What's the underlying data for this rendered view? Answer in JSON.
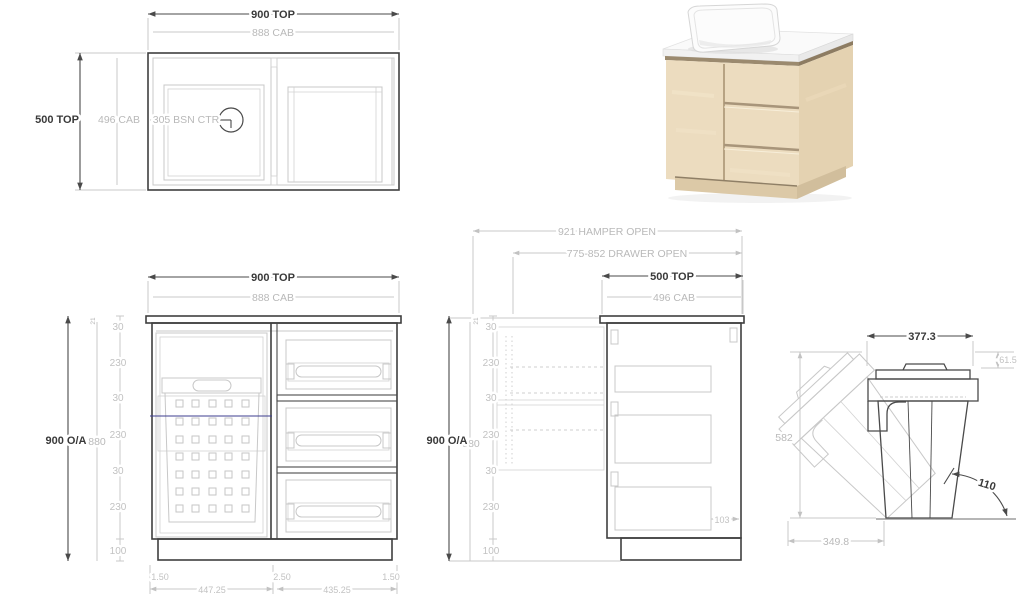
{
  "colors": {
    "background": "#ffffff",
    "line_dark": "#3f3f3f",
    "line_light": "#c8c8c8",
    "text_dark": "#3a3a3a",
    "text_light": "#b9b9b9",
    "marker_blue": "#3d3d8f",
    "wood_front": "#ecdcbf",
    "wood_side": "#e4d2b1",
    "counter_white": "#f5f5f5"
  },
  "plan_view": {
    "dim_top": "900 TOP",
    "dim_top_cab": "888 CAB",
    "dim_depth": "500 TOP",
    "dim_depth_cab": "496 CAB",
    "dim_basin_center": "305 BSN CTR"
  },
  "front_view": {
    "dim_top": "900 TOP",
    "dim_top_cab": "888 CAB",
    "dim_overall": "900 O/A",
    "dim_cab_height": "880",
    "dim_counter_thickness": "21",
    "chain": [
      "30",
      "230",
      "30",
      "230",
      "30",
      "230",
      "100"
    ],
    "bottom_edges": [
      "1.50",
      "2.50",
      "1.50"
    ],
    "dim_bottom_left": "447.25",
    "dim_bottom_right": "435.25"
  },
  "side_view": {
    "dim_hamper_open": "921 HAMPER OPEN",
    "dim_drawer_open": "775-852 DRAWER OPEN",
    "dim_top": "500 TOP",
    "dim_top_cab": "496 CAB",
    "dim_overall": "900 O/A",
    "dim_cab_height": "880",
    "dim_counter_thickness": "21",
    "chain": [
      "30",
      "230",
      "30",
      "230",
      "30",
      "230",
      "100"
    ],
    "dim_drawer_clearance": "103"
  },
  "tilt_view": {
    "dim_width": "377.3",
    "dim_rim_height": "61.5",
    "dim_height": "582",
    "dim_angle": "110",
    "dim_base": "349.8"
  }
}
